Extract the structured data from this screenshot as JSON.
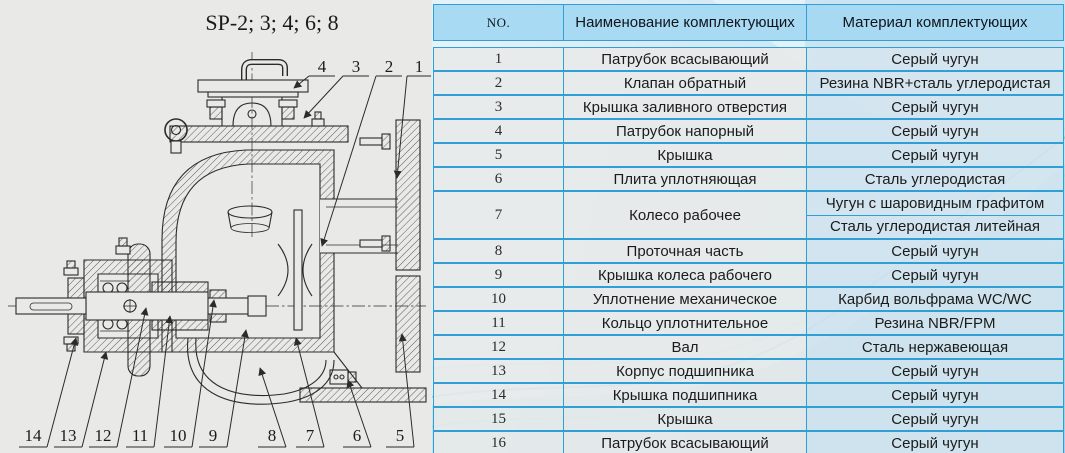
{
  "colors": {
    "table_line_blue": "#2f9fd5",
    "header_blue": "#a7d8f2",
    "row_gray": "#e9eae9",
    "material_tint": "#d5e5ef",
    "panel_blue": "#bedcee",
    "drawing_bg": "#e9e9e7",
    "line_color": "#2b2b2b"
  },
  "diagram": {
    "title": "SP-2; 3; 4; 6; 8",
    "top_callouts": [
      "4",
      "3",
      "2",
      "1"
    ],
    "bottom_callouts": [
      "14",
      "13",
      "12",
      "11",
      "10",
      "9",
      "8",
      "7",
      "6",
      "5"
    ]
  },
  "table": {
    "headers": {
      "no": "NO.",
      "name": "Наименование комплектующих",
      "material": "Материал комплектующих"
    },
    "rows": [
      {
        "no": "1",
        "name": "Патрубок всасывающий",
        "material": "Серый чугун"
      },
      {
        "no": "2",
        "name": "Клапан обратный",
        "material": "Резина NBR+сталь углеродистая"
      },
      {
        "no": "3",
        "name": "Крышка заливного отверстия",
        "material": "Серый чугун"
      },
      {
        "no": "4",
        "name": "Патрубок напорный",
        "material": "Серый чугун"
      },
      {
        "no": "5",
        "name": "Крышка",
        "material": "Серый чугун"
      },
      {
        "no": "6",
        "name": "Плита уплотняющая",
        "material": "Сталь углеродистая"
      },
      {
        "no": "7",
        "name": "Колесо рабочее",
        "materials": [
          "Чугун с шаровидным графитом",
          "Сталь углеродистая литейная"
        ]
      },
      {
        "no": "8",
        "name": "Проточная часть",
        "material": "Серый чугун"
      },
      {
        "no": "9",
        "name": "Крышка колеса рабочего",
        "material": "Серый чугун"
      },
      {
        "no": "10",
        "name": "Уплотнение механическое",
        "material": "Карбид вольфрама WC/WC"
      },
      {
        "no": "11",
        "name": "Кольцо уплотнительное",
        "material": "Резина NBR/FPM"
      },
      {
        "no": "12",
        "name": "Вал",
        "material": "Сталь нержавеющая"
      },
      {
        "no": "13",
        "name": "Корпус подшипника",
        "material": "Серый чугун"
      },
      {
        "no": "14",
        "name": "Крышка подшипника",
        "material": "Серый чугун"
      },
      {
        "no": "15",
        "name": "Крышка",
        "material": "Серый чугун"
      },
      {
        "no": "16",
        "name": "Патрубок всасывающий",
        "material": "Серый чугун"
      }
    ]
  }
}
